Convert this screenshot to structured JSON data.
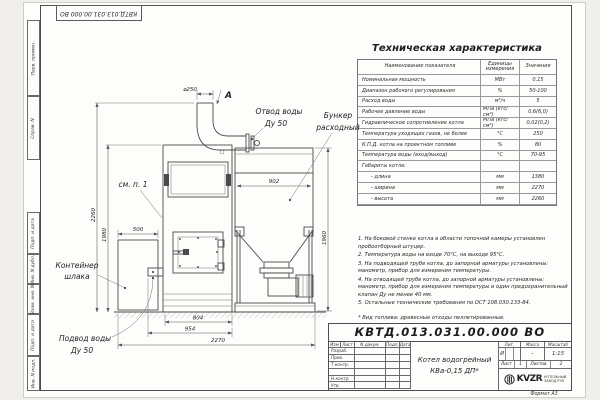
{
  "doc": {
    "number": "КВТД.013.031.00.000  ВО",
    "number_top": "КВТД.013.031.00.000 ВО"
  },
  "frame_labels": {
    "perv_primen": "Перв. примен.",
    "sprav_n": "Справ. N",
    "podp_data_1": "Подп. и дата",
    "inv_dubl": "Инв. N дубл.",
    "vzam_inv": "Взам. инв. N",
    "podp_data_2": "Подп. и дата",
    "inv_podl": "Инв. N подл."
  },
  "tech_table": {
    "title": "Техническая характеристика",
    "headers": [
      "Наименование показателя",
      "Единицы измерения",
      "Значения"
    ],
    "rows": [
      [
        "Номинальная мощность",
        "МВт",
        "0,15"
      ],
      [
        "Диапазон рабочего регулирования",
        "%",
        "50-100"
      ],
      [
        "Расход воды",
        "м³/ч",
        "5"
      ],
      [
        "Рабочее давление воды",
        "МПа (кгс/см²)",
        "0,6(6,0)"
      ],
      [
        "Гидравлическое сопротивление котла",
        "МПа (кгс/см²)",
        "0,02(0,2)"
      ],
      [
        "Температура уходящих газов, не более",
        "°С",
        "250"
      ],
      [
        "К.П.Д. котла на проектном топливе",
        "%",
        "80"
      ],
      [
        "Температура воды (вход/выход)",
        "°С",
        "70-95"
      ],
      [
        "Габариты котла:",
        "",
        ""
      ],
      [
        "- длина",
        "мм",
        "1380"
      ],
      [
        "- ширина",
        "мм",
        "2270"
      ],
      [
        "- высота",
        "мм",
        "2260"
      ]
    ]
  },
  "notes": {
    "items": [
      "1. На боковой стенке котла в области топочной камеры установлен пробоотборный штуцер.",
      "2. Температура воды на входе 70°С, на выходе 95°С.",
      "3. На подводящей трубе котла, до запорной арматуры установлены: манометр, прибор для измерения температуры.",
      "4. На отводящей трубе котла, до запорной арматуры установлены: манометр, прибор для измерения температуры и один предохранительный клапан Ду не менее 40 мм.",
      "5. Остальные технические требования по ОСТ 108.030.133-84."
    ],
    "fuel_note": "* Вид топлива: древесные отходы пеллетированные."
  },
  "title_block": {
    "header_cells": [
      "Изм",
      "Лист",
      "N докум.",
      "Подп.",
      "Дата"
    ],
    "row_labels": [
      "Разраб.",
      "Пров.",
      "Т.контр.",
      "",
      "Н.контр.",
      "Утв."
    ],
    "doc_title_line1": "Котел водогрейный",
    "doc_title_line2": "КВа-0,15 ДП*",
    "lit_label": "Лит.",
    "massa_label": "Масса",
    "masshtab_label": "Масштаб",
    "lit_value": "И",
    "massa_value": "-",
    "masshtab_value": "1:15",
    "list_label": "Лист",
    "list_value": "1",
    "listov_label": "Листов",
    "listov_value": "2",
    "logo_text": "KVZR",
    "company_line1": "КОТЕЛЬНЫЙ",
    "company_line2": "ЗАВОД РЭП",
    "format": "Формат А3"
  },
  "drawing": {
    "labels": {
      "view_a": "А",
      "see_note": "см. п. 1",
      "otvod_1": "Отвод воды",
      "otvod_2": "Ду 50",
      "bunker_1": "Бункер",
      "bunker_2": "расходный",
      "container_1": "Контейнер",
      "container_2": "шлака",
      "podvod_1": "Подвод воды",
      "podvod_2": "Ду 50"
    },
    "dims": {
      "d250": "⌀250",
      "h2260": "2260",
      "h1980": "1980",
      "w500": "500",
      "w902": "902",
      "h1960": "1960",
      "w804": "804",
      "w954": "954",
      "w2270": "2270"
    }
  }
}
